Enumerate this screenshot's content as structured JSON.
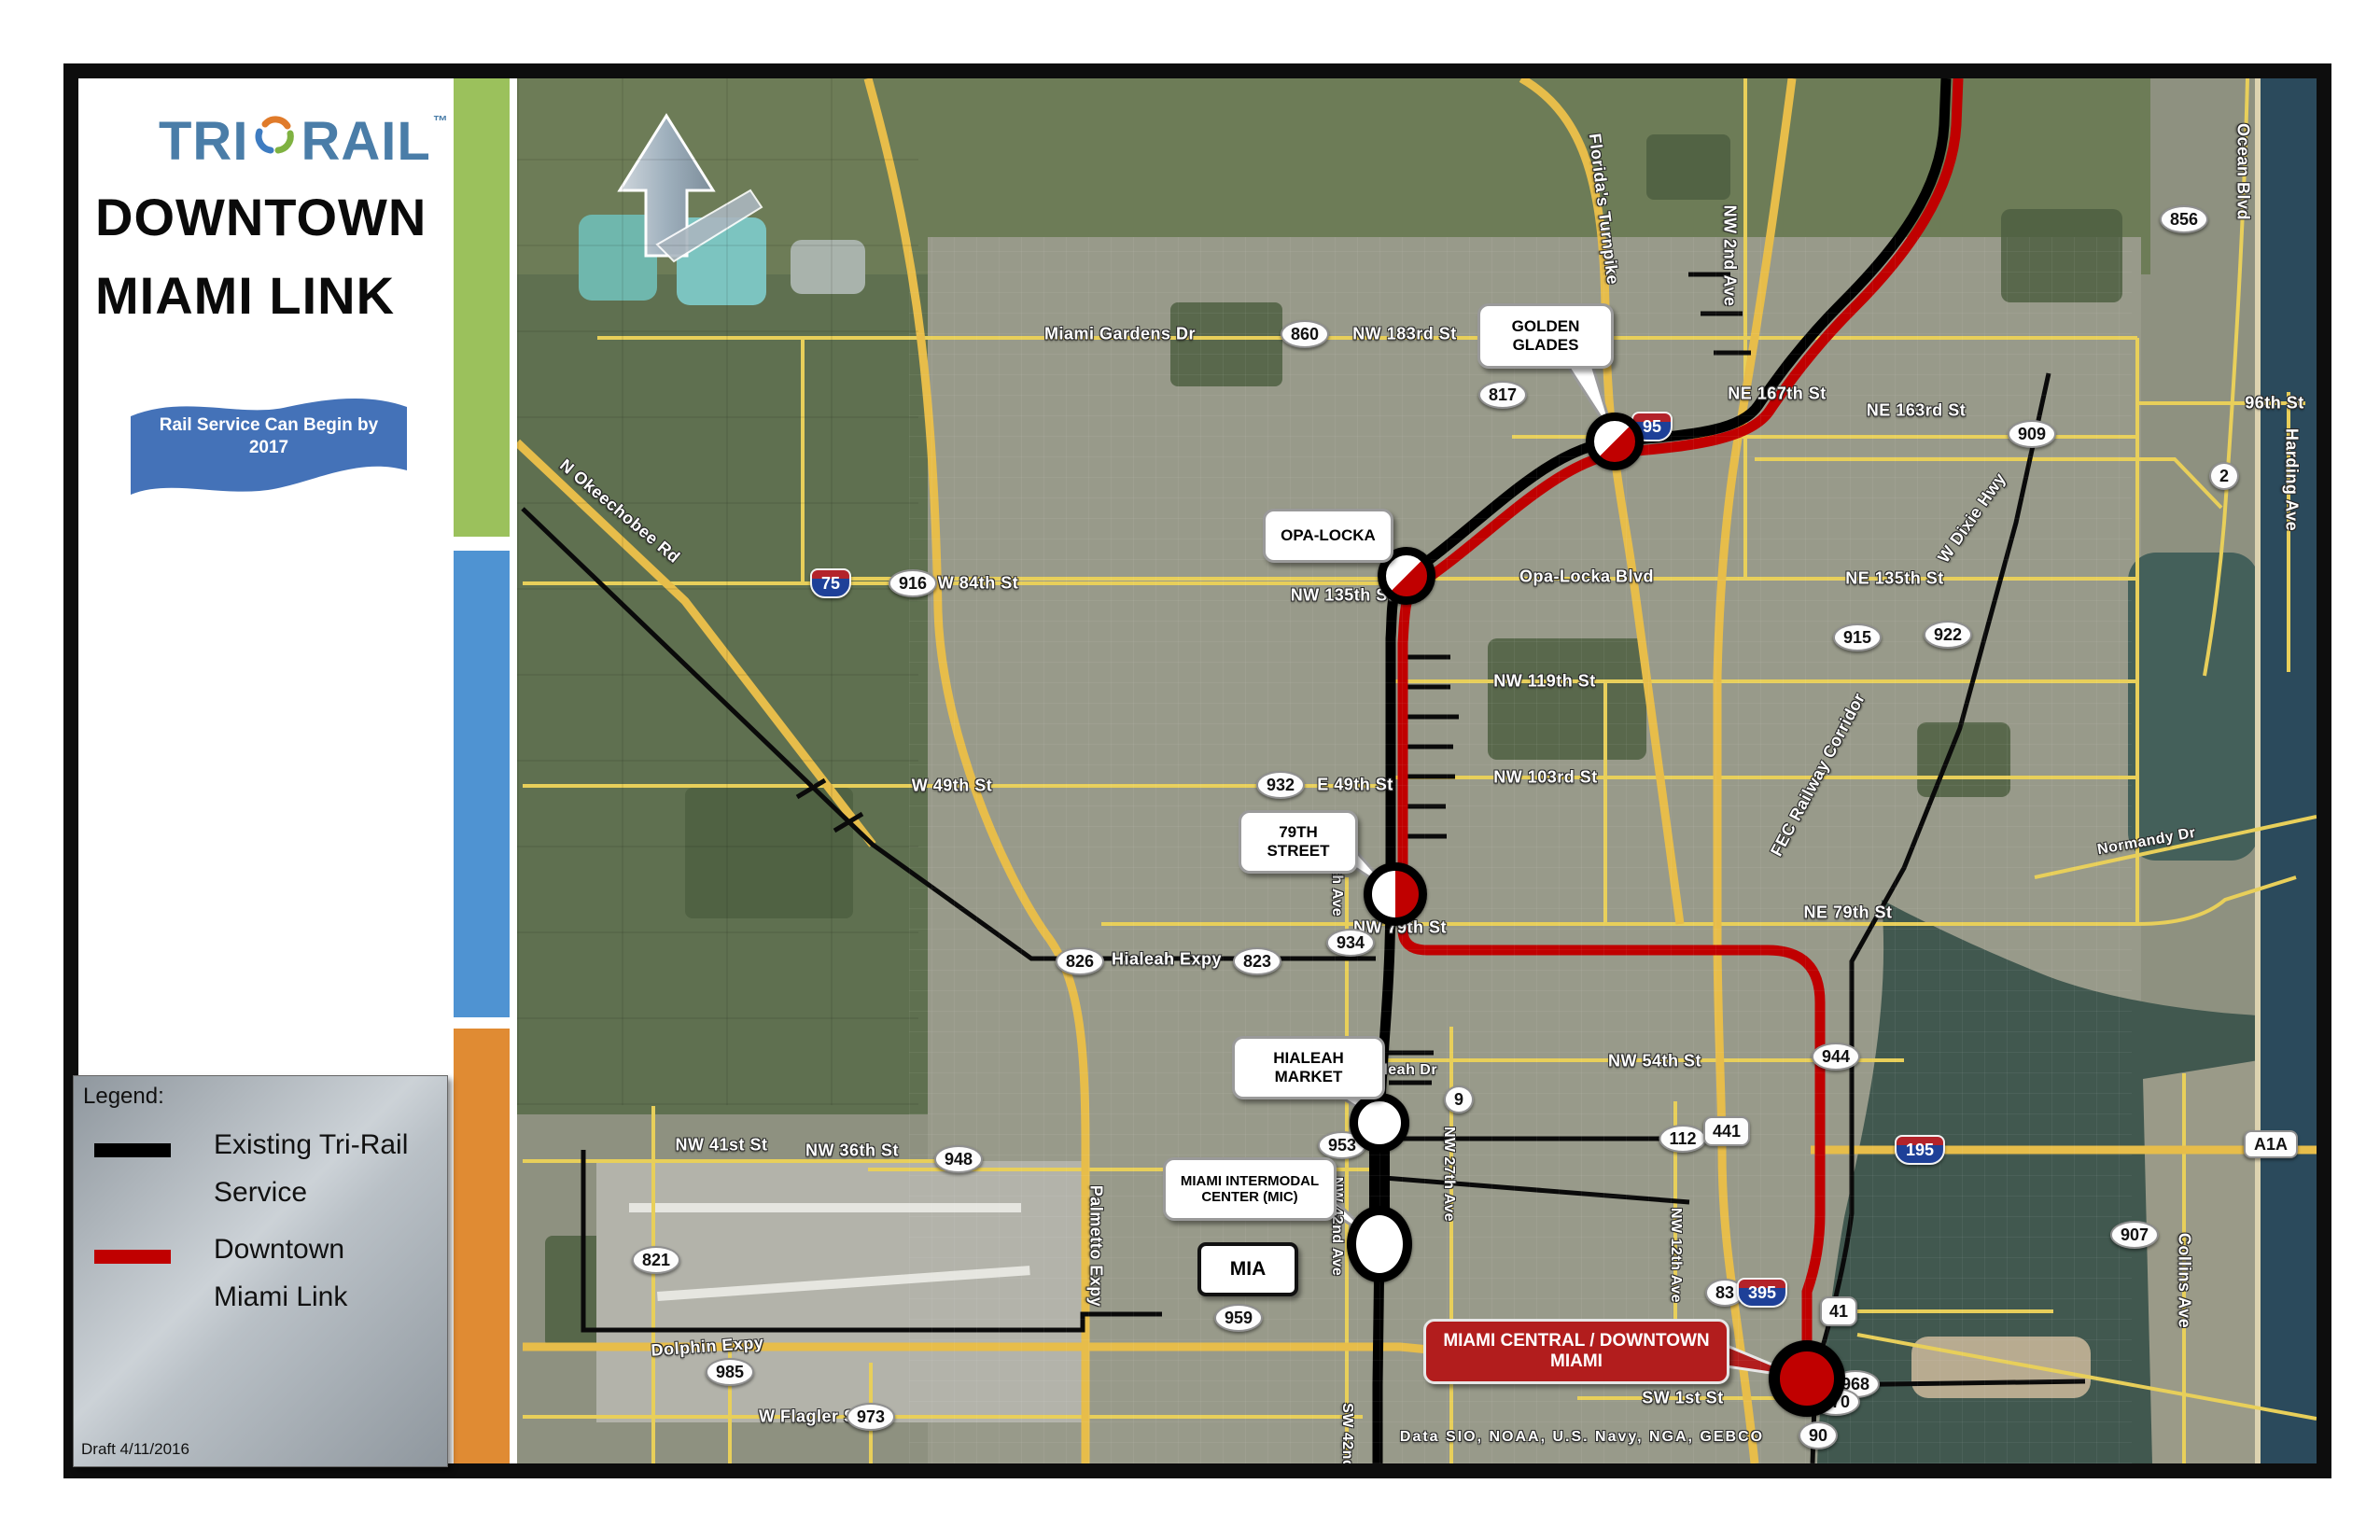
{
  "header": {
    "logo_tri": "TRI",
    "logo_rail": "RAIL",
    "logo_tm": "™",
    "title_line1": "DOWNTOWN",
    "title_line2": "MIAMI LINK"
  },
  "banner": {
    "line1": "Rail Service Can Begin by",
    "line2": "2017"
  },
  "legend": {
    "heading": "Legend:",
    "item1_line1": "Existing Tri-Rail",
    "item1_line2": "Service",
    "item2_line1": "Downtown",
    "item2_line2": "Miami Link",
    "draft": "Draft 4/11/2016"
  },
  "callouts": {
    "golden_glades": "GOLDEN GLADES",
    "opa_locka": "OPA-LOCKA",
    "street_79": "79TH STREET",
    "hialeah_market": "HIALEAH MARKET",
    "mic": "MIAMI INTERMODAL CENTER (MIC)",
    "mia": "MIA",
    "miami_central": "MIAMI CENTRAL / DOWNTOWN MIAMI"
  },
  "roads": {
    "miami_gardens_dr": "Miami Gardens Dr",
    "nw_183rd": "NW 183rd St",
    "ne_167th": "NE 167th St",
    "ne_163rd": "NE 163rd St",
    "ocean_blvd": "Ocean Blvd",
    "harding_ave": "Harding Ave",
    "w_dixie": "W Dixie Hwy",
    "opa_locka_blvd": "Opa-Locka Blvd",
    "ne_135th": "NE 135th St",
    "nw_135th": "NW 135th St",
    "w_84th": "W 84th St",
    "s_96th": "96th St",
    "floridas_turnpike": "Florida's Turnpike",
    "nw_2nd_ave": "NW 2nd Ave",
    "n_okeechobee": "N Okeechobee Rd",
    "nw_119th": "NW 119th St",
    "nw_103rd": "NW 103rd St",
    "w_49th": "W 49th St",
    "e_49th": "E 49th St",
    "fec": "FEC Railway Corridor",
    "ne_79th": "NE 79th St",
    "nw_79th": "NW 79th St",
    "e_8th_ave": "E 8th Ave",
    "normandy": "Normandy Dr",
    "hialeah_expy": "Hialeah Expy",
    "nw_54th": "NW 54th St",
    "hialeah_dr": "Hialeah Dr",
    "nw_41st": "NW 41st St",
    "nw_36th": "NW 36th St",
    "palmetto": "Palmetto Expy",
    "nw_42nd_ave": "NW 42nd Ave",
    "nw_27th_ave": "NW 27th Ave",
    "nw_12th_ave": "NW 12th Ave",
    "dolphin": "Dolphin Expy",
    "w_flagler": "W Flagler St",
    "sw_1st": "SW 1st St",
    "collins": "Collins Ave",
    "sw_42nd": "SW 42nd Ave"
  },
  "shields": {
    "s860": "860",
    "s817": "817",
    "s909": "909",
    "s856": "856",
    "s2": "2",
    "s916": "916",
    "s915": "915",
    "s922": "922",
    "s932": "932",
    "s934": "934",
    "s823": "823",
    "s826": "826",
    "s948": "948",
    "s821": "821",
    "s985": "985",
    "s973": "973",
    "s959": "959",
    "s953": "953",
    "s9": "9",
    "s944": "944",
    "s112": "112",
    "s968": "968",
    "s970": "970",
    "s90": "90",
    "s907": "907",
    "s83": "83",
    "s441": "441",
    "s41": "41",
    "i75": "75",
    "i95": "95",
    "i195": "195",
    "i395": "395",
    "a1a": "A1A"
  },
  "attribution": "Data SIO, NOAA, U.S. Navy, NGA, GEBCO",
  "colors": {
    "strip_green": "#9bc15c",
    "strip_blue": "#4f93d2",
    "strip_orange": "#e08b33",
    "banner_blue": "#4472b8",
    "link_red": "#c00000",
    "rail_black": "#000000",
    "road_yellow": "#e8cf5a"
  }
}
